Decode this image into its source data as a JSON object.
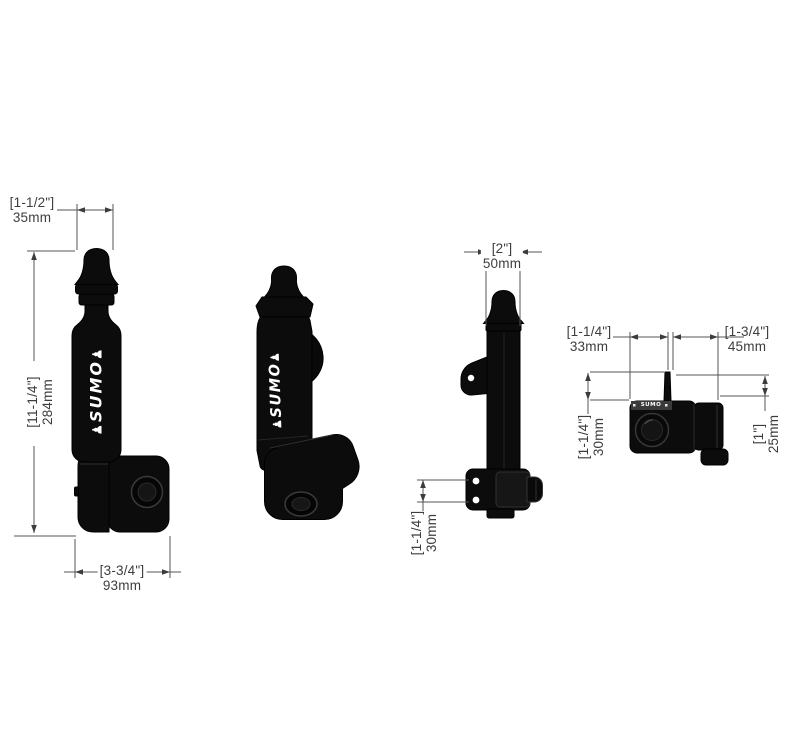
{
  "drawing": {
    "background": "#ffffff",
    "line_color": "#565656",
    "arrow_color": "#3c3c3c",
    "text_color": "#3d3d3d",
    "product_color": "#0c0c0c"
  },
  "brand": {
    "name": "SUMO",
    "glyph": "♟"
  },
  "dimensions": {
    "v1_top": {
      "inches": "[1-1/2\"]",
      "mm": "35mm"
    },
    "v1_height": {
      "inches": "[11-1/4\"]",
      "mm": "284mm"
    },
    "v1_bottom": {
      "inches": "[3-3/4\"]",
      "mm": "93mm"
    },
    "v3_top": {
      "inches": "[2\"]",
      "mm": "50mm"
    },
    "v3_bottom": {
      "inches": "[1-1/4\"]",
      "mm": "30mm"
    },
    "v4_top_left": {
      "inches": "[1-1/4\"]",
      "mm": "33mm"
    },
    "v4_top_right": {
      "inches": "[1-3/4\"]",
      "mm": "45mm"
    },
    "v4_left": {
      "inches": "[1-1/4\"]",
      "mm": "30mm"
    },
    "v4_right": {
      "inches": "[1\"]",
      "mm": "25mm"
    }
  }
}
